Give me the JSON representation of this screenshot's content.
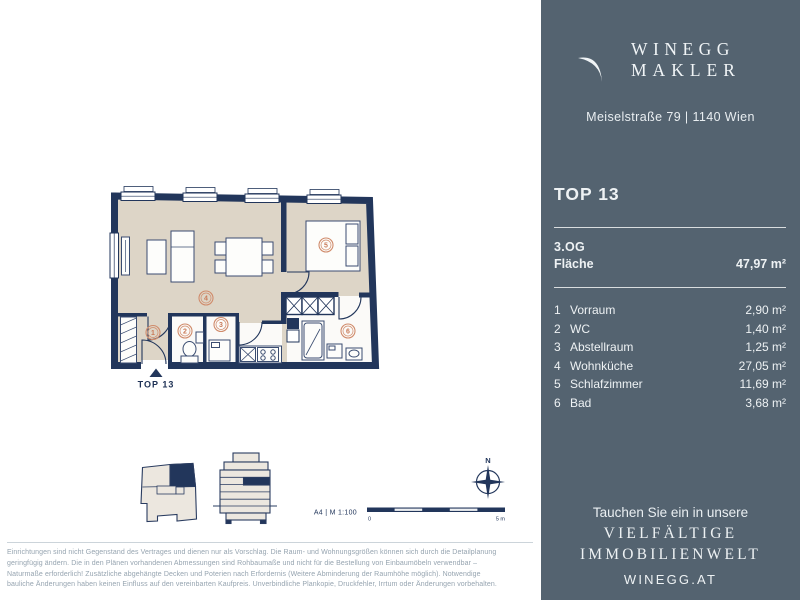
{
  "colors": {
    "panel_bg": "#546370",
    "plan_navy": "#22365b",
    "floor_beige": "#ddd5c7",
    "marker_salmon": "#c97a58",
    "disclaimer_gray": "#96a4b0"
  },
  "brand": {
    "logo_line1": "WINEGG",
    "logo_line2": "MAKLER",
    "address": "Meiselstraße 79 | 1140 Wien"
  },
  "unit": {
    "title": "TOP 13",
    "floor": "3.OG",
    "area_label": "Fläche",
    "area_value": "47,97 m²"
  },
  "rooms": [
    {
      "number": "1",
      "name": "Vorraum",
      "area": "2,90 m²"
    },
    {
      "number": "2",
      "name": "WC",
      "area": "1,40 m²"
    },
    {
      "number": "3",
      "name": "Abstellraum",
      "area": "1,25 m²"
    },
    {
      "number": "4",
      "name": "Wohnküche",
      "area": "27,05 m²"
    },
    {
      "number": "5",
      "name": "Schlafzimmer",
      "area": "11,69 m²"
    },
    {
      "number": "6",
      "name": "Bad",
      "area": "3,68 m²"
    }
  ],
  "floor_plan": {
    "entrance_label": "TOP 13",
    "compass_north": "N",
    "scale_caption": "A4 | M 1:100",
    "scale_zero": "0",
    "scale_max": "5 m"
  },
  "footer_panel": {
    "intro": "Tauchen Sie ein in unsere",
    "headline1": "VIELFÄLTIGE",
    "headline2": "IMMOBILIENWELT",
    "website": "WINEGG.AT"
  },
  "disclaimer": {
    "line1": "Einrichtungen sind nicht Gegenstand des Vertrages und dienen nur als Vorschlag. Die Raum- und Wohnungsgrößen können sich durch die Detailplanung",
    "line2": "geringfügig ändern. Die in den Plänen vorhandenen Abmessungen sind Rohbaumaße und nicht für die Bestellung von Einbaumöbeln verwendbar –",
    "line3": "Naturmaße erforderlich! Zusätzliche abgehängte Decken und Poterien nach Erfordernis (Weitere Abminderung der Raumhöhe möglich). Notwendige",
    "line4": "bauliche Änderungen haben keinen Einfluss auf den vereinbarten Kaufpreis. Unverbindliche Plankopie, Druckfehler, Irrtum oder Änderungen vorbehalten."
  }
}
